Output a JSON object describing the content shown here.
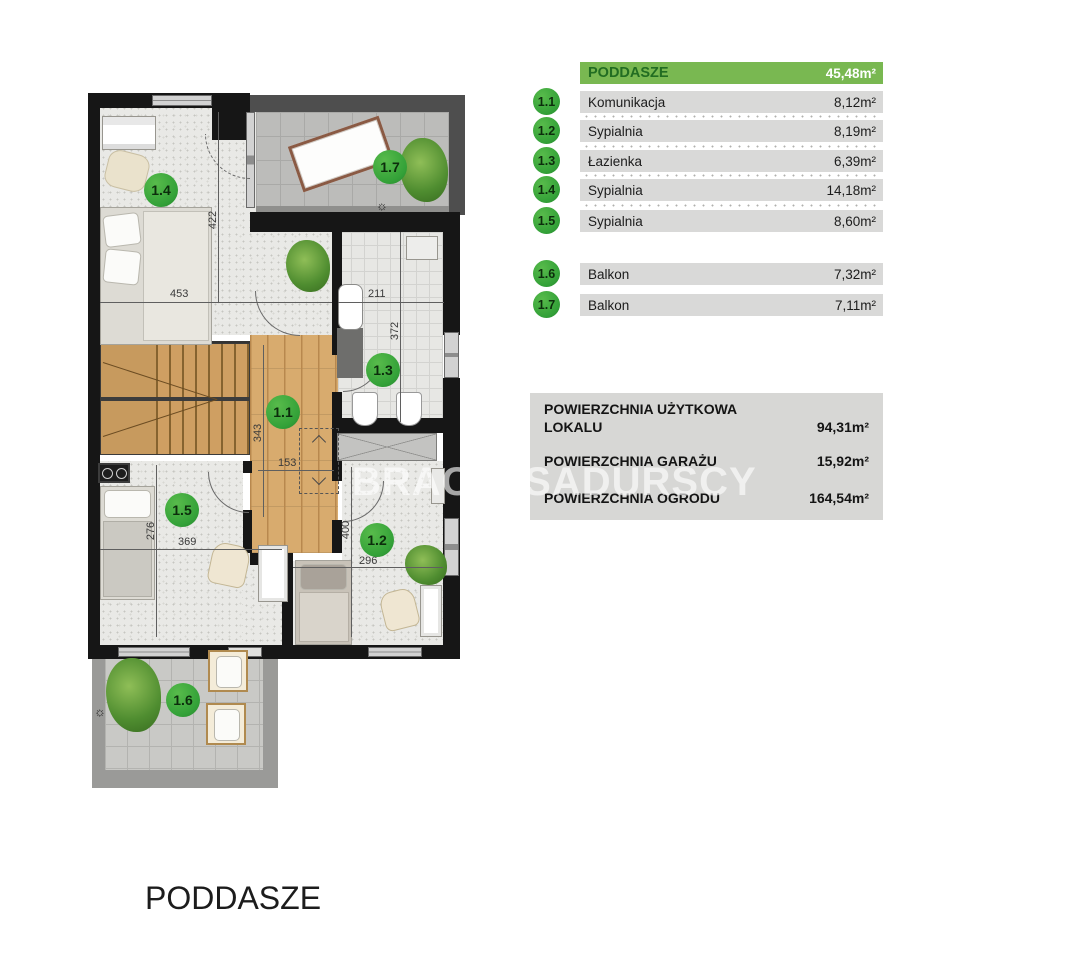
{
  "watermark": "BRACIA SADURSCY",
  "floor_title": "PODDASZE",
  "colors": {
    "header_green": "#79b851",
    "header_text_green": "#226d22",
    "badge_green": "#33a138",
    "row_gray": "#d9d9d8",
    "wall_black": "#161616"
  },
  "legend": {
    "header": {
      "label": "PODDASZE",
      "area": "45,48m²"
    },
    "rooms": [
      {
        "id": "1.1",
        "name": "Komunikacja",
        "area": "8,12m²"
      },
      {
        "id": "1.2",
        "name": "Sypialnia",
        "area": "8,19m²"
      },
      {
        "id": "1.3",
        "name": "Łazienka",
        "area": "6,39m²"
      },
      {
        "id": "1.4",
        "name": "Sypialnia",
        "area": "14,18m²"
      },
      {
        "id": "1.5",
        "name": "Sypialnia",
        "area": "8,60m²"
      }
    ],
    "balconies": [
      {
        "id": "1.6",
        "name": "Balkon",
        "area": "7,32m²"
      },
      {
        "id": "1.7",
        "name": "Balkon",
        "area": "7,11m²"
      }
    ]
  },
  "summary": {
    "rows": [
      {
        "label": "POWIERZCHNIA UŻYTKOWA LOKALU",
        "label_line1": "POWIERZCHNIA UŻYTKOWA",
        "label_line2": "LOKALU",
        "value": "94,31m²"
      },
      {
        "label": "POWIERZCHNIA GARAŻU",
        "value": "15,92m²"
      },
      {
        "label": "POWIERZCHNIA OGRODU",
        "value": "164,54m²"
      }
    ]
  },
  "plan": {
    "markers": [
      {
        "id": "1.4"
      },
      {
        "id": "1.7"
      },
      {
        "id": "1.3"
      },
      {
        "id": "1.1"
      },
      {
        "id": "1.5"
      },
      {
        "id": "1.2"
      },
      {
        "id": "1.6"
      }
    ],
    "dimensions": [
      "422",
      "453",
      "211",
      "372",
      "343",
      "153",
      "276",
      "369",
      "400",
      "296"
    ],
    "icons": {
      "sun": "☼"
    }
  }
}
